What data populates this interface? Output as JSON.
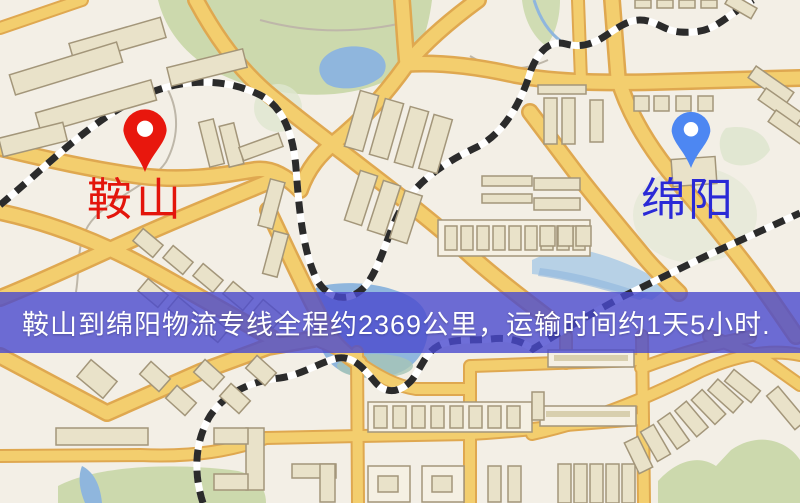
{
  "markers": {
    "anshan": {
      "label": "鞍山",
      "pin_color": "#e8170d",
      "label_color": "#e3150b"
    },
    "mianyang": {
      "label": "绵阳",
      "pin_color": "#4d87f2",
      "label_color": "#2a2ad6"
    }
  },
  "banner": {
    "text": "鞍山到绵阳物流专线全程约2369公里，运输时间约1天5小时.",
    "origin": "鞍山",
    "destination": "绵阳",
    "distance": "约2369公里",
    "duration": "约1天5小时",
    "bg_color": "#4a4ace",
    "text_color": "#ffffff"
  },
  "map_colors": {
    "background": "#f3efe6",
    "road_fill": "#f3ce6e",
    "road_casing": "#dfa850",
    "park_green": "#ccd9ad",
    "water_blue": "#8fb6dd",
    "building_tan": "#e9e2c9",
    "building_outline": "#a3967a",
    "railway_dark": "#2b2b2b",
    "railway_light": "#ffffff"
  }
}
